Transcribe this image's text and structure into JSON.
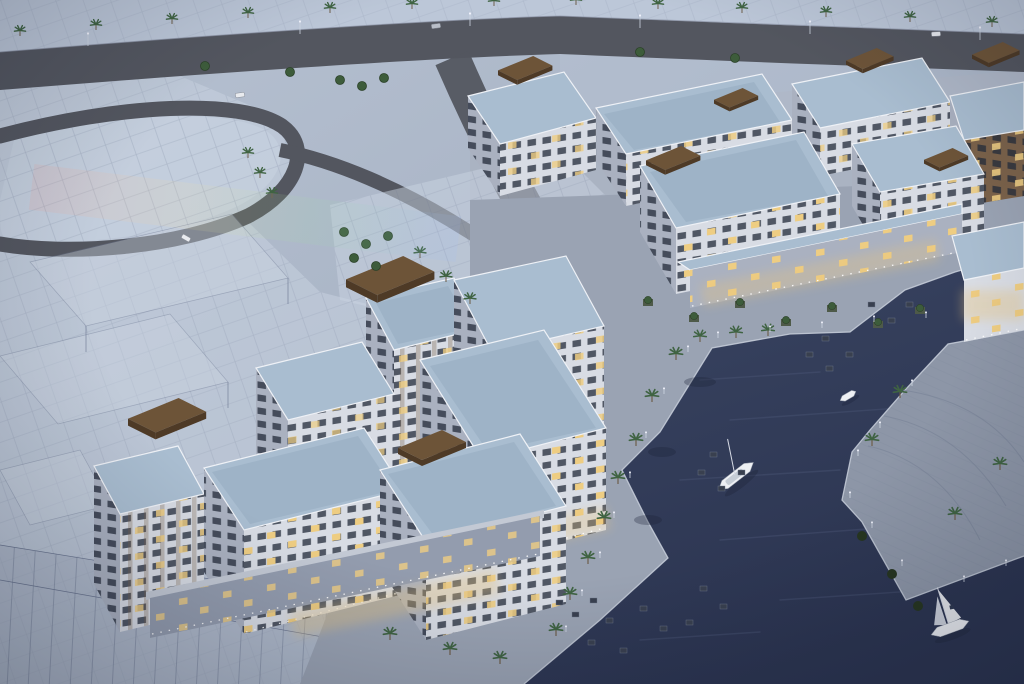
{
  "scene": {
    "description": "Dusk aerial architectural rendering of a waterfront residential development: white low-rise apartment blocks with warm lit windows and brown rooftop pergolas around a dark marina canal, palm-lined promenades with cafe furniture, a moored sailboat, a small motorboat and a sailing yacht on the water, perimeter roads lined with palm trees, and translucent wireframe massing of future phases on the left",
    "time_of_day": "dusk",
    "view": "aerial three-quarter",
    "water_body": "marina canal",
    "counts": {
      "sailboats": 2,
      "motorboats": 1,
      "rooftop_pergolas": 9,
      "cars": 4,
      "street_lamps": 6
    },
    "colors": {
      "land": "#aab6c8",
      "landLight": "#bcc7d8",
      "pavement": "#aab3c2",
      "promenade": "#9aa3b3",
      "stone": "#8d96a7",
      "road": "#53565f",
      "water1": "#3a4562",
      "water2": "#2b3450",
      "quay": "#c9d0dc",
      "facadeLight": "#d8dce4",
      "facadeShade": "#aab1c0",
      "facadeDark": "#939cae",
      "facadeBrown": "#7b624a",
      "roof": "#a9bdd0",
      "roofDark": "#96abbf",
      "parapet": "#eef1f6",
      "pergola": "#6d5438",
      "pergolaDark": "#4e3a26",
      "windowDark": "#232a39",
      "windowLit": "#eecd82",
      "palm": "#3f6342",
      "bush": "#3d5c3b",
      "bushDark": "#26351f",
      "trunk": "#6b5a44",
      "planter": "#4e5a49",
      "wire": "#6b7690",
      "ghostFill": "#c9d3e2",
      "sail": "#e8eaee",
      "hull": "#eef0f4",
      "glow": "#e8c37a",
      "furniture": "#39404f",
      "lamp": "#f4f6ff"
    }
  }
}
